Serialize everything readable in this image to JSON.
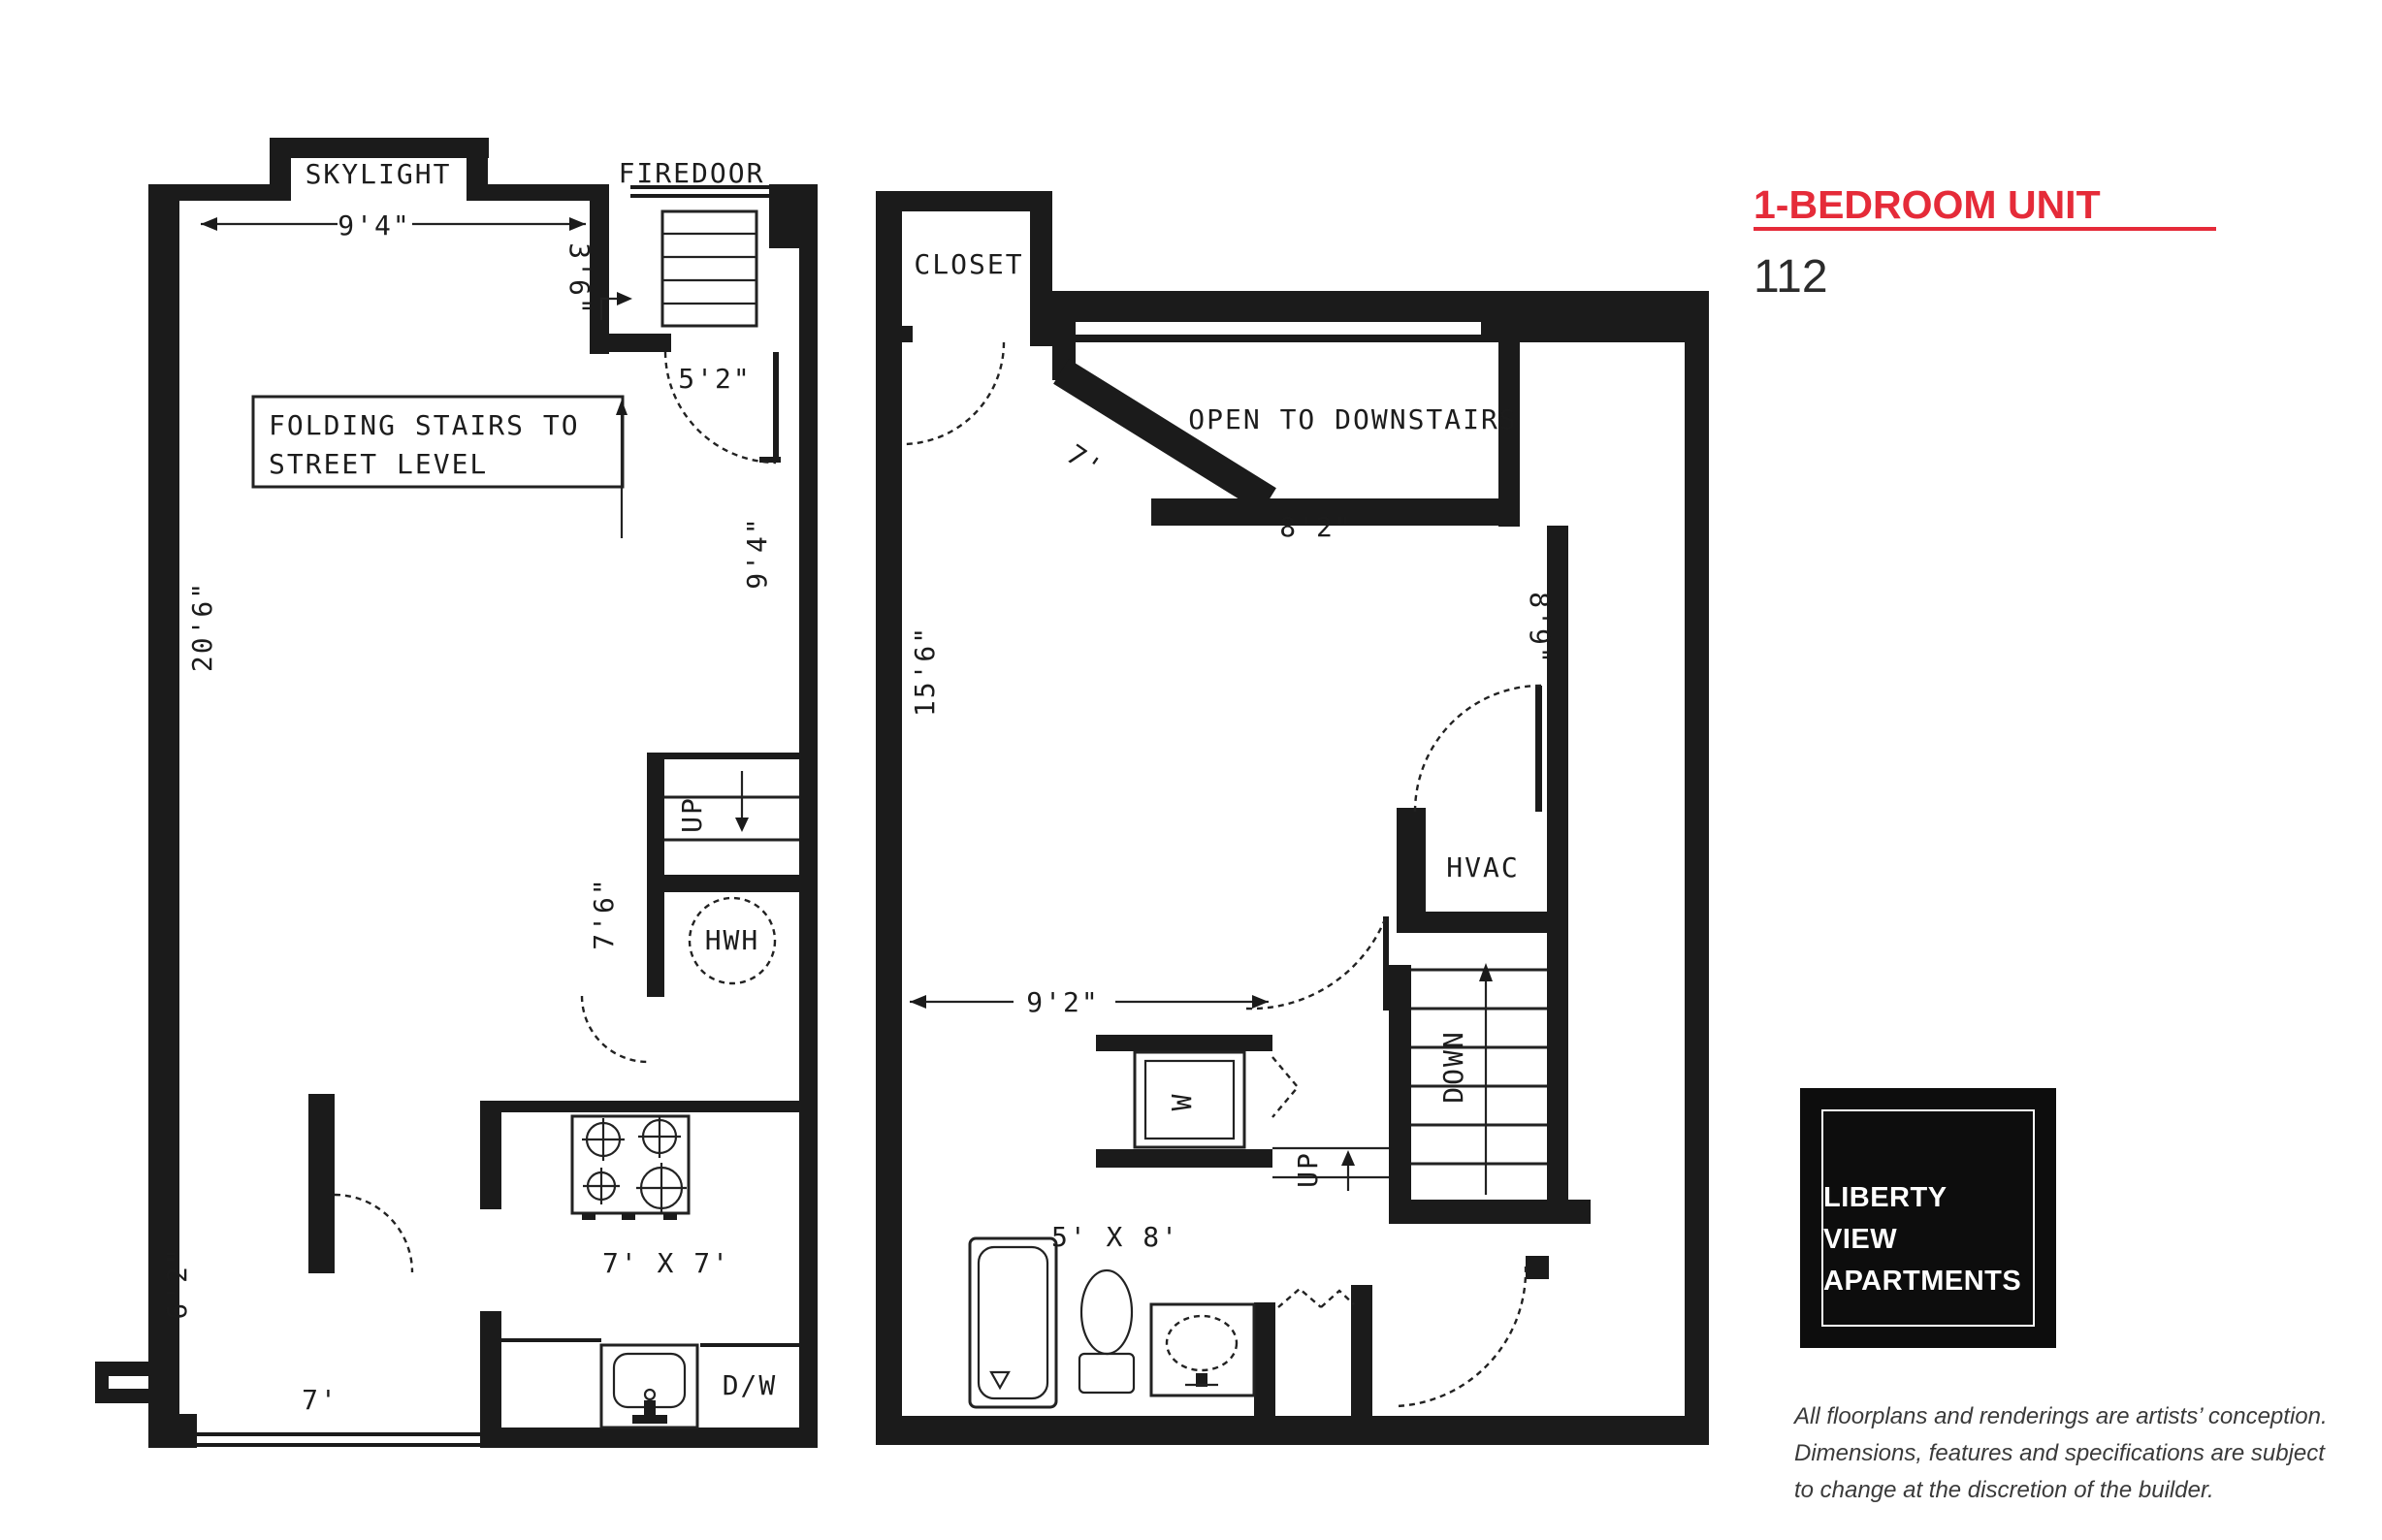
{
  "header": {
    "title": "1-BEDROOM UNIT",
    "unit_number": "112"
  },
  "colors": {
    "accent": "#e52b39",
    "ink": "#1b1b1b"
  },
  "logo": {
    "line1": "LIBERTY",
    "line2": "VIEW",
    "line3": "APARTMENTS"
  },
  "disclaimer": {
    "line1": "All floorplans and renderings are artists’ conception.",
    "line2": "Dimensions, features and specifications are subject",
    "line3": "to change at the discretion of the builder."
  },
  "plan_upper": {
    "skylight_label": "SKYLIGHT",
    "skylight_width": "9'4\"",
    "firedoor_label": "FIREDOOR",
    "entry_door_width": "5'2\"",
    "stair_note_line1": "FOLDING STAIRS TO",
    "stair_note_line2": "STREET LEVEL",
    "closet_depth": "3'6\"",
    "room_length": "20'6\"",
    "right_wall_height": "9'4\"",
    "hall_width": "7'6\"",
    "up_label": "UP",
    "water_heater_label": "HWH",
    "kitchen_size": "7' X 7'",
    "dishwasher_label": "D/W",
    "bottom_width": "7'",
    "alcove_height": "6'2\""
  },
  "plan_lower": {
    "closet_label": "CLOSET",
    "open_label": "OPEN TO DOWNSTAIRS",
    "open_width": "8'2\"",
    "angled_wall": "7'",
    "room_length": "15'6\"",
    "nook_depth": "8'9\"",
    "hvac_label": "HVAC",
    "down_label": "DOWN",
    "up_label": "UP",
    "washer_label": "W",
    "room_width": "9'2\"",
    "bath_size": "5' X 8'"
  }
}
